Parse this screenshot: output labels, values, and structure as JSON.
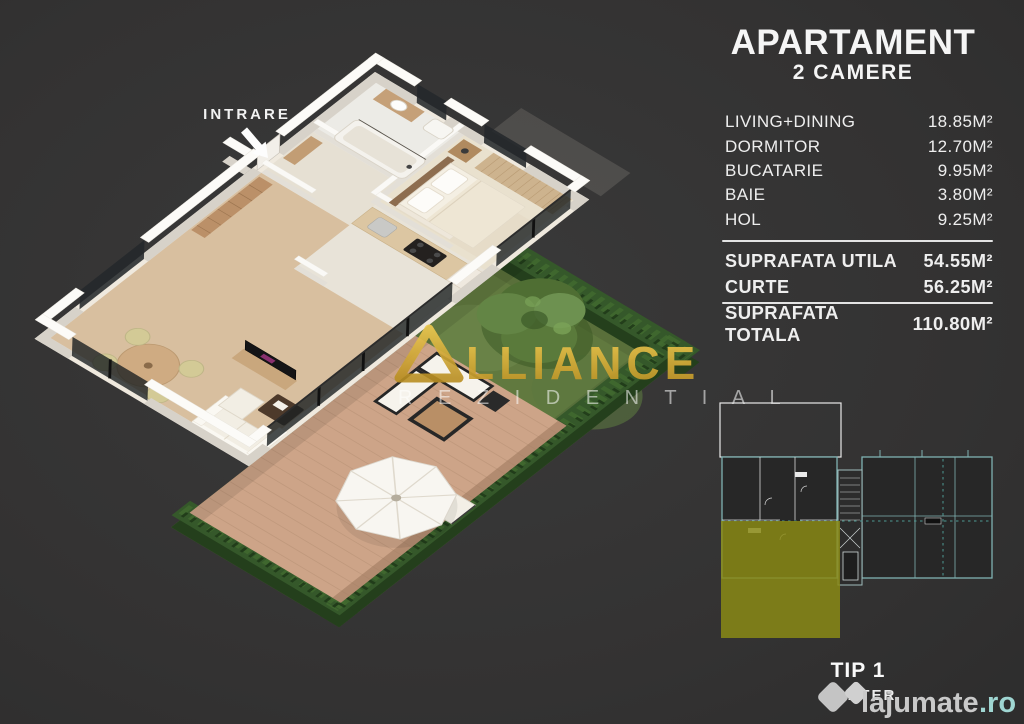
{
  "background": {
    "color": "#323232"
  },
  "entrance": {
    "label": "INTRARE"
  },
  "brand_watermark": {
    "name": "ALLIANCE",
    "display_after_logo": "LLIANCE",
    "line2": "R E Z I D E N T I A L",
    "gold_color": "#d4a93c"
  },
  "spec_panel": {
    "title": "APARTAMENT",
    "subtitle": "2 CAMERE",
    "rooms": [
      {
        "label": "LIVING+DINING",
        "value": "18.85M²"
      },
      {
        "label": "DORMITOR",
        "value": "12.70M²"
      },
      {
        "label": "BUCATARIE",
        "value": "9.95M²"
      },
      {
        "label": "BAIE",
        "value": "3.80M²"
      },
      {
        "label": "HOL",
        "value": "9.25M²"
      }
    ],
    "subtotals": [
      {
        "label": "SUPRAFATA UTILA",
        "value": "54.55M²"
      },
      {
        "label": "CURTE",
        "value": "56.25M²"
      }
    ],
    "total": {
      "label": "SUPRAFATA TOTALA",
      "value": "110.80M²"
    }
  },
  "mini_plan": {
    "type_label": "TIP 1",
    "floor_label": "PARTER",
    "highlight_color": "#8a8a15",
    "line_color": "#7fb2b2"
  },
  "site_watermark": {
    "name": "lajumate",
    "tld": ".ro",
    "tld_color": "#9fd6d2"
  }
}
